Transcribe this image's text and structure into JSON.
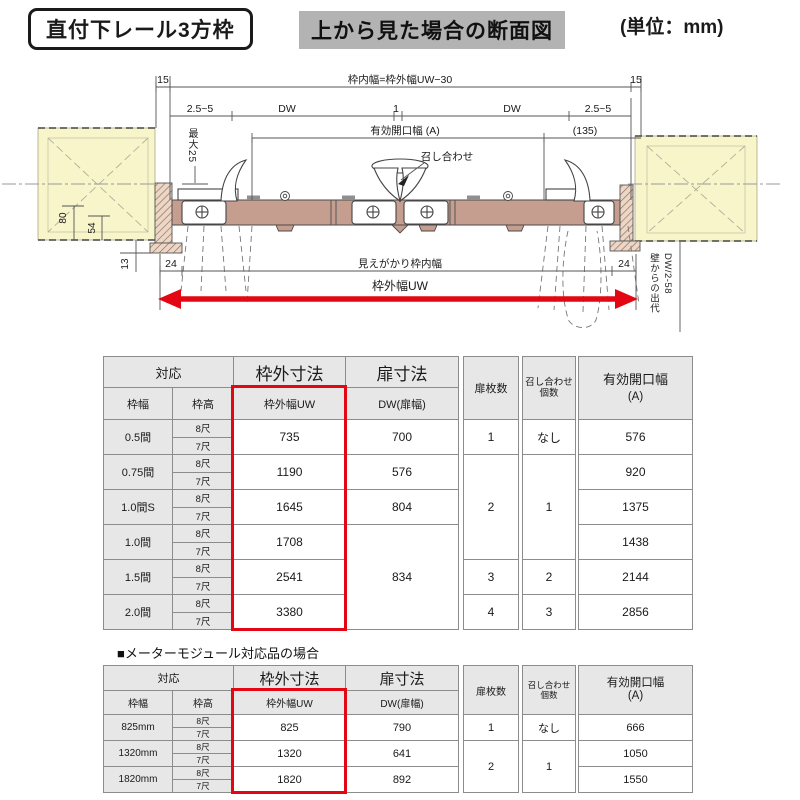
{
  "header": {
    "product_label": "直付下レール3方枠",
    "view_label": "上から見た場合の断面図",
    "unit_label": "(単位：mm)"
  },
  "diagram": {
    "dims": {
      "top_left_15": "15",
      "top_right_15": "15",
      "inner_width_formula": "枠内幅=枠外幅UW−30",
      "clearance_left": "2.5~5",
      "dw_left": "DW",
      "center_gap": "1",
      "dw_right": "DW",
      "clearance_right": "2.5~5",
      "effective_opening": "有効開口幅 (A)",
      "offset_135": "(135)",
      "meeting": "召し合わせ",
      "max25": "最大25",
      "d80": "80",
      "d54": "54",
      "d13": "13",
      "left_24": "24",
      "right_24": "24",
      "visible_inner_width": "見えがかり枠内幅",
      "outer_width": "枠外幅UW",
      "wall_protrusion": "壁からの出代",
      "wall_protrusion_formula": "DW/2-58"
    },
    "colors": {
      "wall": "#f7f5c9",
      "rail": "#c59e90",
      "hatch_bg": "#ecd7c7",
      "hatch_line": "#8a6a56",
      "red": "#e30613"
    }
  },
  "table_section": {
    "module_heading": "■メーターモジュール対応品の場合",
    "highlight_color": "#e30613",
    "header_bg": "#e7e7e7",
    "headers": {
      "correspond": "対応",
      "frame_width": "枠幅",
      "frame_height": "枠高",
      "outer_dim": "枠外寸法",
      "outer_width_uw": "枠外幅UW",
      "door_dim": "扉寸法",
      "dw_door_width": "DW(扉幅)",
      "door_count": "扉枚数",
      "meeting_count_1": "召し合わせ",
      "meeting_count_2": "個数",
      "effective_1": "有効開口幅",
      "effective_2": "(A)"
    },
    "heights": [
      "8尺",
      "7尺"
    ],
    "table1_rows": [
      {
        "label": "0.5間",
        "uw": "735",
        "dw": {
          "v": "700",
          "span": 1
        },
        "doors": {
          "v": "1",
          "span": 1
        },
        "meet": {
          "v": "なし",
          "span": 1
        },
        "open": "576"
      },
      {
        "label": "0.75間",
        "uw": "1190",
        "dw": {
          "v": "576",
          "span": 1
        },
        "doors": {
          "v": "2",
          "span": 3
        },
        "meet": {
          "v": "1",
          "span": 3
        },
        "open": "920"
      },
      {
        "label": "1.0間S",
        "uw": "1645",
        "dw": {
          "v": "804",
          "span": 1
        },
        "open": "1375"
      },
      {
        "label": "1.0間",
        "uw": "1708",
        "dw": {
          "v": "834",
          "span": 3
        },
        "open": "1438"
      },
      {
        "label": "1.5間",
        "uw": "2541",
        "doors": {
          "v": "3",
          "span": 1
        },
        "meet": {
          "v": "2",
          "span": 1
        },
        "open": "2144"
      },
      {
        "label": "2.0間",
        "uw": "3380",
        "doors": {
          "v": "4",
          "span": 1
        },
        "meet": {
          "v": "3",
          "span": 1
        },
        "open": "2856"
      }
    ],
    "table2_rows": [
      {
        "label": "825mm",
        "uw": "825",
        "dw": {
          "v": "790",
          "span": 1
        },
        "doors": {
          "v": "1",
          "span": 1
        },
        "meet": {
          "v": "なし",
          "span": 1
        },
        "open": "666"
      },
      {
        "label": "1320mm",
        "uw": "1320",
        "dw": {
          "v": "641",
          "span": 1
        },
        "doors": {
          "v": "2",
          "span": 2
        },
        "meet": {
          "v": "1",
          "span": 2
        },
        "open": "1050"
      },
      {
        "label": "1820mm",
        "uw": "1820",
        "dw": {
          "v": "892",
          "span": 1
        },
        "open": "1550"
      }
    ]
  }
}
